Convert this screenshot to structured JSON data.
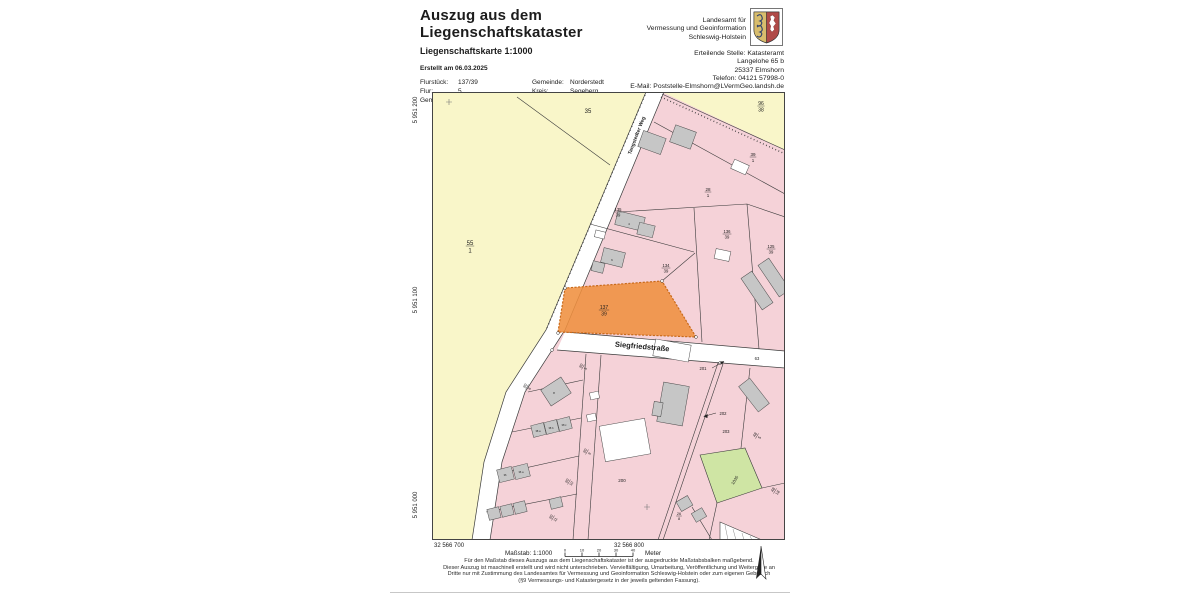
{
  "header": {
    "title_line1": "Auszug aus dem",
    "title_line2": "Liegenschaftskataster",
    "subtitle": "Liegenschaftskarte 1:1000",
    "created": "Erstellt am 06.03.2025",
    "parcel_info": {
      "flurstueck_label": "Flurstück:",
      "flurstueck_value": "137/39",
      "flur_label": "Flur:",
      "flur_value": "5",
      "gemarkung_label": "Gemarkung:",
      "gemarkung_value": "Glashütte",
      "gemeinde_label": "Gemeinde:",
      "gemeinde_value": "Norderstedt",
      "kreis_label": "Kreis:",
      "kreis_value": "Segeberg"
    },
    "agency": {
      "line1": "Landesamt für",
      "line2": "Vermessung und Geoinformation",
      "line3": "Schleswig-Holstein"
    },
    "issuing_office": {
      "line1": "Erteilende Stelle: Katasteramt",
      "line2": "Langelohe 65 b",
      "line3": "25337 Elmshorn",
      "line4": "Telefon: 04121 57998-0",
      "line5": "E-Mail: Poststelle-Elmshorn@LVermGeo.landsh.de"
    }
  },
  "map": {
    "highlighted_parcel": "137/39",
    "colors": {
      "field_yellow": "#f9f6c9",
      "residential_pink": "#f5d2d8",
      "building_gray": "#c6c6c6",
      "highlight_orange": "#ef8f3f",
      "green_area": "#cfe5a4",
      "road_white": "#ffffff"
    },
    "grid": {
      "northing_labels": [
        "5 951 200",
        "5 951 100",
        "5 951 000"
      ],
      "easting_labels": [
        "32 566 700",
        "32 566 800"
      ]
    },
    "labels": [
      {
        "name": "street-label-tangstedter-weg",
        "text": "Tangstedter Weg",
        "x": 206,
        "y": 44,
        "rot": -69,
        "size": 5,
        "bold": true
      },
      {
        "name": "street-label-siegfriedstrasse",
        "text": "Siegfriedstraße",
        "x": 210,
        "y": 257,
        "rot": 5,
        "size": 7.5,
        "bold": true
      },
      {
        "name": "parcel-35",
        "text": "35",
        "x": 156,
        "y": 21,
        "size": 6
      },
      {
        "name": "parcel-55-1",
        "num": "55",
        "den": "1",
        "x": 38,
        "y": 154,
        "size": 6
      },
      {
        "name": "parcel-96-38",
        "num": "96",
        "den": "38",
        "x": 329,
        "y": 14,
        "size": 5
      },
      {
        "name": "parcel-39-1",
        "num": "39",
        "den": "1",
        "x": 321,
        "y": 65,
        "size": 4.5
      },
      {
        "name": "parcel-28-1",
        "num": "28",
        "den": "1",
        "x": 276,
        "y": 100,
        "size": 4.5
      },
      {
        "name": "parcel-135-39",
        "num": "135",
        "den": "39",
        "x": 186,
        "y": 120,
        "size": 4.2
      },
      {
        "name": "parcel-136-39",
        "num": "136",
        "den": "39",
        "x": 295,
        "y": 142,
        "size": 4.2
      },
      {
        "name": "parcel-125-39",
        "num": "125",
        "den": "39",
        "x": 339,
        "y": 157,
        "size": 4.2
      },
      {
        "name": "parcel-134-39",
        "num": "134",
        "den": "39",
        "x": 234,
        "y": 176,
        "size": 4.2
      },
      {
        "name": "parcel-137-39",
        "num": "137",
        "den": "39",
        "x": 172,
        "y": 218,
        "size": 5
      },
      {
        "name": "parcel-63",
        "text": "63",
        "x": 325,
        "y": 268,
        "size": 4.2
      },
      {
        "name": "parcel-201",
        "text": "201",
        "x": 271,
        "y": 278,
        "size": 4.2
      },
      {
        "name": "parcel-202",
        "text": "202",
        "x": 291,
        "y": 323,
        "size": 4.2
      },
      {
        "name": "parcel-203",
        "text": "203",
        "x": 294,
        "y": 341,
        "size": 4.2
      },
      {
        "name": "parcel-48-5",
        "num": "48",
        "den": "5",
        "x": 325,
        "y": 344,
        "rot": -58,
        "size": 4
      },
      {
        "name": "parcel-1035",
        "text": "1035",
        "x": 304,
        "y": 389,
        "rot": -58,
        "size": 4.2
      },
      {
        "name": "parcel-48-18",
        "num": "48",
        "den": "18",
        "x": 343,
        "y": 399,
        "rot": -58,
        "size": 4
      },
      {
        "name": "parcel-26-8",
        "num": "26",
        "den": "8",
        "x": 247,
        "y": 424,
        "size": 3.8
      },
      {
        "name": "parcel-200",
        "text": "200",
        "x": 190,
        "y": 390,
        "size": 4.5
      },
      {
        "name": "parcel-90-5",
        "num": "90",
        "den": "5",
        "x": 151,
        "y": 275,
        "rot": -58,
        "size": 3.8
      },
      {
        "name": "parcel-90-6",
        "num": "90",
        "den": "6",
        "x": 95,
        "y": 295,
        "rot": -58,
        "size": 3.8
      },
      {
        "name": "parcel-90-9",
        "num": "90",
        "den": "9",
        "x": 155,
        "y": 360,
        "rot": -58,
        "size": 3.8
      },
      {
        "name": "parcel-90-10",
        "num": "90",
        "den": "10",
        "x": 137,
        "y": 390,
        "rot": -58,
        "size": 3.8
      },
      {
        "name": "parcel-90-11",
        "num": "90",
        "den": "11",
        "x": 121,
        "y": 426,
        "rot": -58,
        "size": 3.8
      },
      {
        "name": "house-number-4",
        "text": "4",
        "x": 197,
        "y": 133,
        "size": 3
      },
      {
        "name": "house-number-6",
        "text": "6",
        "x": 180,
        "y": 169,
        "size": 3
      },
      {
        "name": "house-number-8",
        "text": "8",
        "x": 122,
        "y": 302,
        "size": 3
      },
      {
        "name": "house-number-38a",
        "text": "38 a",
        "x": 106,
        "y": 340,
        "size": 2.6
      },
      {
        "name": "house-number-38b",
        "text": "38 b",
        "x": 119,
        "y": 337,
        "size": 2.6
      },
      {
        "name": "house-number-38c",
        "text": "38 c",
        "x": 132,
        "y": 334,
        "size": 2.6
      },
      {
        "name": "house-number-36",
        "text": "36",
        "x": 73,
        "y": 384,
        "size": 2.6
      },
      {
        "name": "house-number-36a",
        "text": "36 a",
        "x": 89,
        "y": 381,
        "size": 2.6
      }
    ]
  },
  "footer": {
    "scale_label": "Maßstab: 1:1000",
    "scale_unit": "Meter",
    "scale_ticks": [
      "0",
      "10",
      "20",
      "30",
      "40"
    ],
    "legal_lines": [
      "Für den Maßstab dieses Auszugs aus dem Liegenschaftskataster ist der ausgedruckte Maßstabsbalken maßgebend.",
      "Dieser Auszug ist maschinell erstellt und wird nicht unterschrieben. Vervielfältigung, Umarbeitung, Veröffentlichung und Weitergabe an",
      "Dritte nur mit Zustimmung des Landesamtes für Vermessung und Geoinformation Schleswig-Holstein oder zum eigenen Gebrauch",
      "(§9 Vermessungs- und Katastergesetz in der jeweils geltenden Fassung)."
    ]
  }
}
